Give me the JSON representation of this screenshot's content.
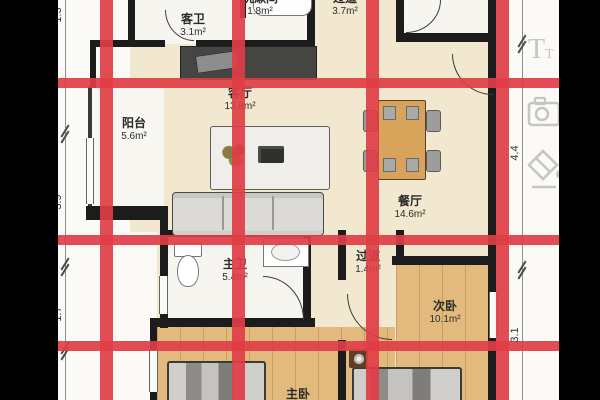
{
  "floorplan": {
    "rooms": [
      {
        "id": "guest-bath",
        "name": "客卫",
        "area": "3.1m²"
      },
      {
        "id": "washroom",
        "name": "洗漱间",
        "area": "1.8m²"
      },
      {
        "id": "hallway-top",
        "name": "过道",
        "area": "3.7m²"
      },
      {
        "id": "living-room",
        "name": "客厅",
        "area": "13.8m²"
      },
      {
        "id": "balcony",
        "name": "阳台",
        "area": "5.6m²"
      },
      {
        "id": "dining-room",
        "name": "餐厅",
        "area": "14.6m²"
      },
      {
        "id": "master-bath",
        "name": "主卫",
        "area": "5.4m²"
      },
      {
        "id": "hallway-inner",
        "name": "过道",
        "area": "1.4m²"
      },
      {
        "id": "second-bedroom",
        "name": "次卧",
        "area": "10.1m²"
      },
      {
        "id": "master-bedroom",
        "name": "主卧",
        "area": ""
      }
    ],
    "dimensions": {
      "left": [
        "1.5",
        "3.9",
        "1.7"
      ],
      "right": [
        "4.4",
        "3.1"
      ]
    },
    "grid_overlay": {
      "color": "#df3e46",
      "vertical_lines": 4,
      "horizontal_lines": 3
    },
    "colors": {
      "cream_floor": "#f1e8cf",
      "wood_floor": "#e3ba7d",
      "white_room": "#f7f5f0",
      "wall": "#1c1c1c"
    }
  },
  "toolbar": {
    "icons": [
      {
        "name": "text-tool"
      },
      {
        "name": "camera"
      },
      {
        "name": "paint-bucket"
      }
    ]
  }
}
